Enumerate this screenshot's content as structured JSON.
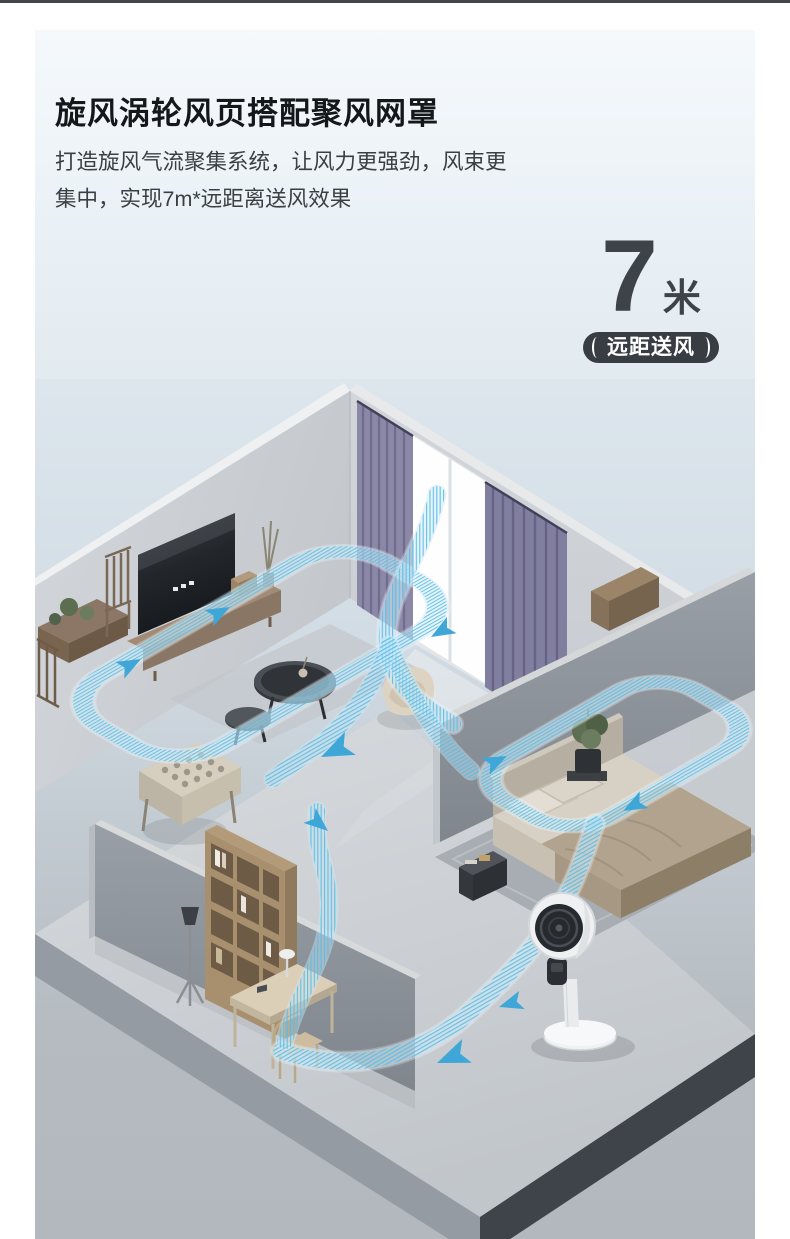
{
  "header": {
    "title": "旋风涡轮风页搭配聚风网罩",
    "subtitle_line1": "打造旋风气流聚集系统，让风力更强劲，风束更",
    "subtitle_line2": "集中，实现7m*远距离送风效果"
  },
  "highlight": {
    "value": "7",
    "unit": "米",
    "badge_label": "远距送风"
  },
  "colors": {
    "top_strip": "#43474c",
    "title_text": "#15181b",
    "body_text": "#3a3f44",
    "metric_text": "#3d4349",
    "badge_bg": "#383d43",
    "badge_text": "#ffffff",
    "panel_gradient_top": "#f5f9fb",
    "panel_gradient_bottom": "#dbe4eb",
    "scene_background_gray": "#b3b9bf",
    "airflow_stripe": "#58bde6",
    "airflow_arrow": "#3fa6d8",
    "curtain_purple": "#8886a5"
  }
}
